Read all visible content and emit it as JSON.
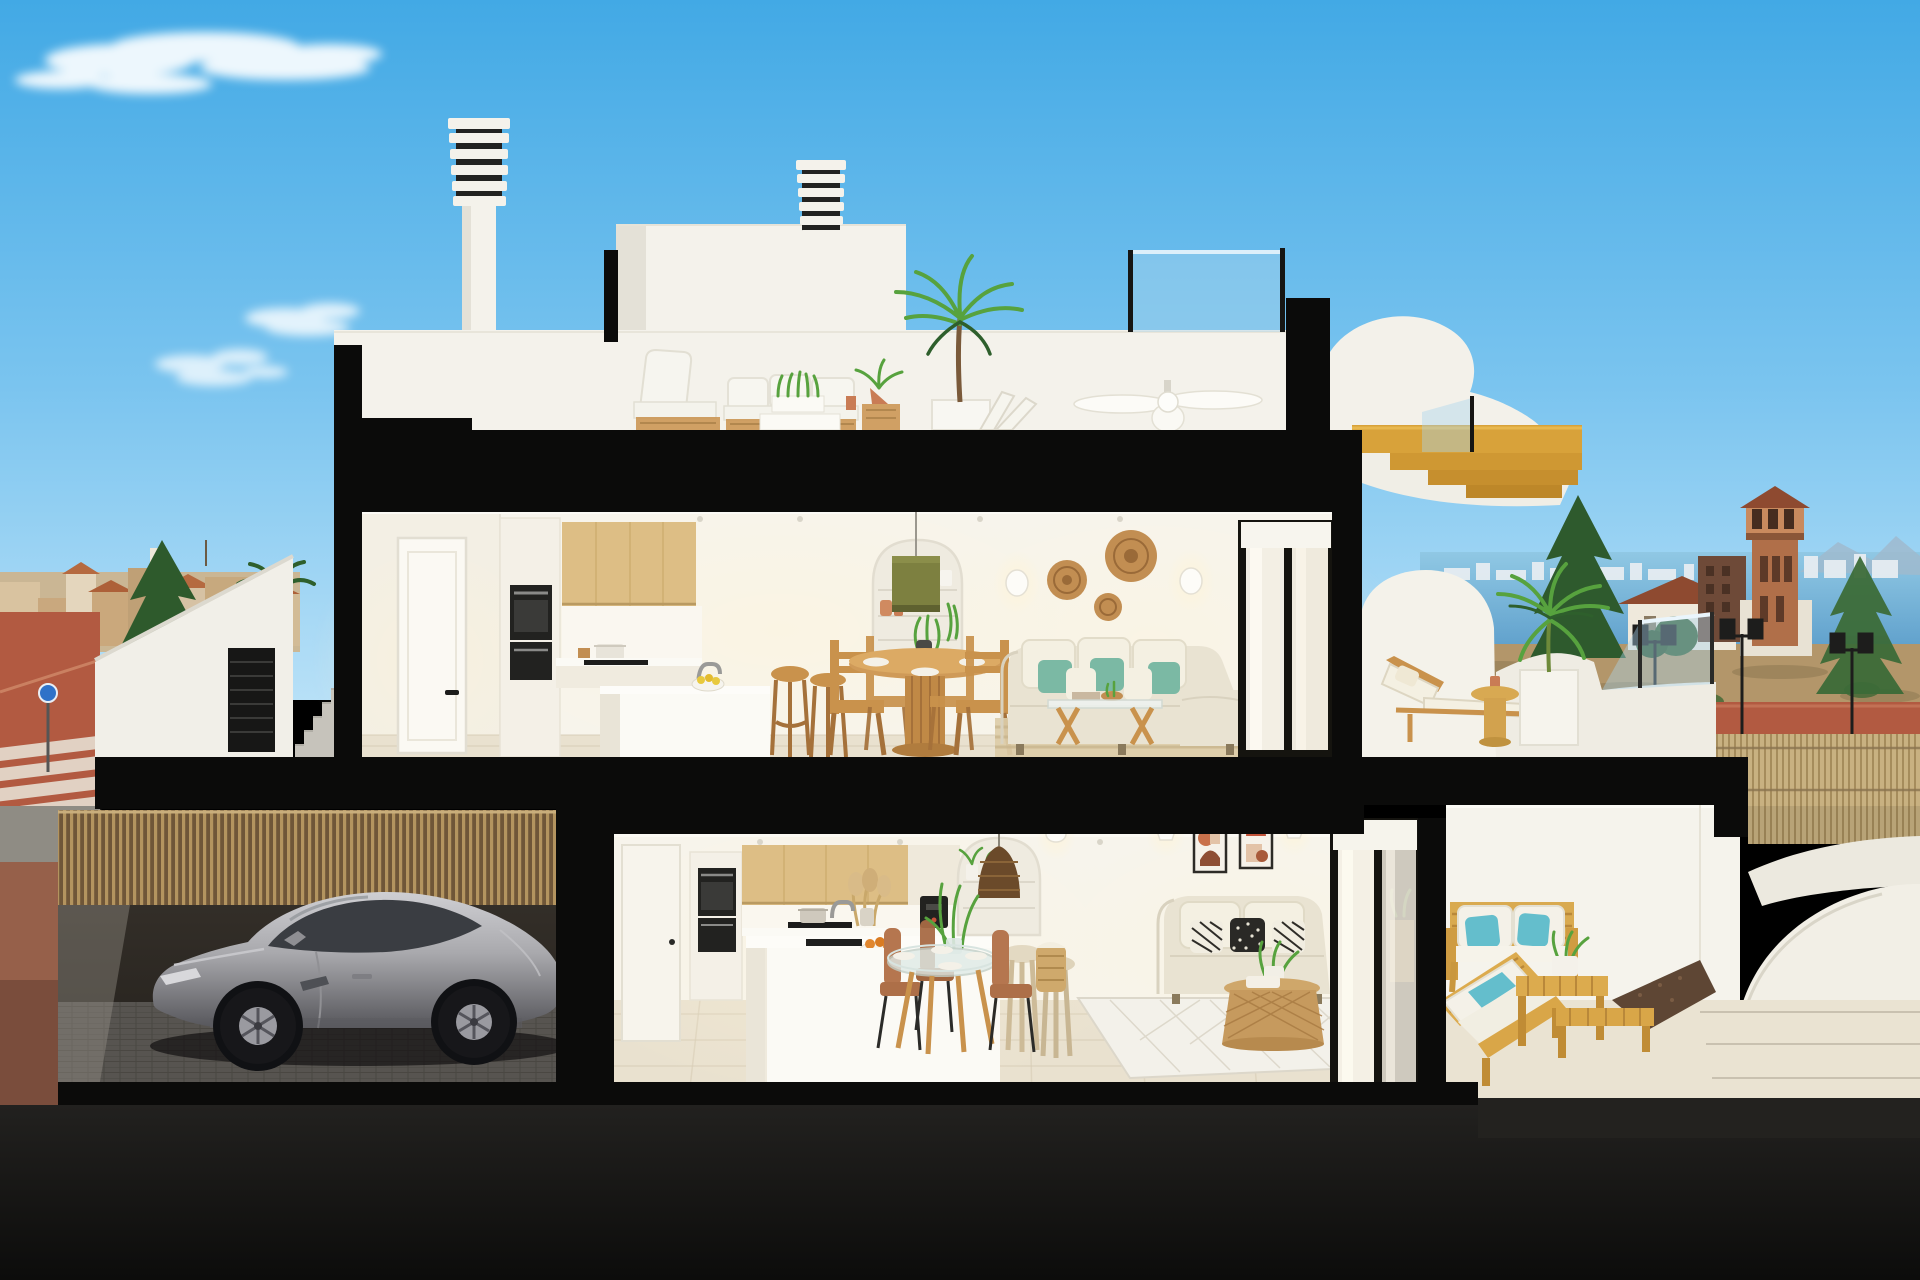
{
  "meta": {
    "type": "3d-architectural-render",
    "description": "Cutaway cross-section render of a modern two-storey coastal townhouse: roof terrace with chimneys and lounge set, upper floor with kitchen/dining/living and sun terrace, lower floor with kitchen/dining/living and covered terrace, garage with a silver sports car, sea and town in the background",
    "visible_text": "none",
    "canvas": {
      "width": 1920,
      "height": 1280
    }
  },
  "palette": {
    "sky_top": "#42A9E5",
    "sky_mid": "#7AC4EF",
    "sky_low": "#B7E0F7",
    "cloud": "#FFFFFF",
    "sea": "#5E9FCB",
    "sea_light": "#90C8E4",
    "skyline_white": "#E6EDF2",
    "mountain_blue": "#9FBACE",
    "cut_black": "#0B0B0A",
    "wall_white": "#F4F2EB",
    "wall_shade": "#E4E1D7",
    "interior_wall": "#F7F4EC",
    "warm_glow": "#FFF3D6",
    "counter_white": "#FBFAF5",
    "floor_tile": "#E9E1CF",
    "floor_line": "#D5CAB2",
    "terrace_floor": "#E8E0CC",
    "wood_cabinet": "#DDBE85",
    "wood_stair": "#D8A23A",
    "wood_furniture": "#C9924C",
    "wood_dark": "#A5713A",
    "oven_black": "#222220",
    "sofa_beige": "#E9E3D2",
    "cushion_cream": "#F4F0E2",
    "teal": "#7BB9A4",
    "cyan_teal": "#64BECC",
    "rattan": "#C28E52",
    "plant_green": "#57A23E",
    "plant_dark": "#2E5F2C",
    "terracotta": "#C97C55",
    "street_red": "#B25A41",
    "road_gray": "#8F8C84",
    "field_tan": "#B3966A",
    "reed": "#C8B181",
    "slat_light": "#B3945F",
    "slat_dark": "#6F5638",
    "tower_brick": "#B06F49",
    "roof_red": "#8E4A30",
    "town_tan": "#CEB28A",
    "car_silver": "#A9A9AD",
    "car_dark": "#56565B",
    "glass_blue": "#A9D3EC",
    "ground_dark": "#161614",
    "garage_dark": "#221F1B",
    "paver": "#7C7973"
  },
  "scene": {
    "sky": {
      "clouds": [
        "wispy-cloud-top-left",
        "small-puff-left",
        "small-puff-lower-left",
        "faint-wisp-right"
      ]
    },
    "background_left": [
      "town-skyline",
      "conifer-tree",
      "palm-tree",
      "red-paved-street",
      "pedestrian-crossing",
      "round-blue-sign",
      "white-boundary-wall",
      "entrance-stairs",
      "black-louvre-gate"
    ],
    "background_right": [
      "sea-horizon",
      "distant-city-skyline",
      "distant-mountains",
      "dry-field",
      "red-street",
      "ornate-lamp-posts",
      "reed-fence",
      "white-garden-walls",
      "house-with-red-roof",
      "brick-building",
      "watchtower",
      "conifer-trees"
    ],
    "roof_level": [
      "louvred-chimney-left",
      "louvred-chimney-right",
      "penthouse-volume",
      "roof-parapet",
      "glass-railing",
      "outdoor-lounge-chair",
      "outdoor-sofa",
      "planter-table",
      "potted-plant",
      "tall-palm",
      "folded-lounger",
      "ceiling-fan",
      "curved-stair-volume",
      "wooden-staircase"
    ],
    "upper_floor": {
      "entry": [
        "interior-door"
      ],
      "kitchen": [
        "oven-column",
        "double-oven",
        "oak-wall-cabinets",
        "counter",
        "cooktop",
        "cooking-pot",
        "kitchen-island",
        "faucet",
        "fruit-bowl",
        "bar-stools"
      ],
      "dining": [
        "green-pendant-lamp",
        "arched-niche-shelves",
        "terracotta-vases",
        "trailing-plant",
        "round-wood-table",
        "wood-chairs",
        "plates",
        "vase-centerpiece"
      ],
      "living": [
        "wall-sconces",
        "rattan-wall-plates",
        "corner-sofa",
        "teal-cushions",
        "glass-coffee-table",
        "jute-rug",
        "sliding-glass-door",
        "roller-blind"
      ],
      "terrace": [
        "curved-parapet",
        "glass-balustrade",
        "sun-lounger",
        "side-table",
        "palm-in-cube-planter"
      ]
    },
    "lower_floor": {
      "kitchen": [
        "garage-door",
        "oven-column",
        "oak-wall-cabinets",
        "counter",
        "cooktop",
        "coffee-machine",
        "dried-pampas",
        "peninsula-island",
        "sink",
        "orange-bowl",
        "stools"
      ],
      "dining": [
        "arched-niche-shelves",
        "rattan-pendant",
        "potted-plants",
        "glass-dining-table",
        "brown-chairs",
        "plant-centerpiece",
        "laundry-basket"
      ],
      "living": [
        "framed-abstract-art",
        "wall-sconces",
        "two-seat-sofa",
        "patterned-cushions",
        "rattan-coffee-table",
        "diamond-rug",
        "sliding-glass-door"
      ],
      "terrace": [
        "wooden-outdoor-sofa",
        "teal-outdoor-cushions",
        "wooden-coffee-table",
        "wooden-bench",
        "potted-plant",
        "gravel-strip",
        "paved-path"
      ]
    },
    "garage": [
      "timber-slat-fence",
      "silver-sports-car",
      "paver-floor"
    ],
    "structure": [
      "black-section-cut-slabs",
      "floor-slabs",
      "foundation",
      "dark-ground"
    ]
  }
}
